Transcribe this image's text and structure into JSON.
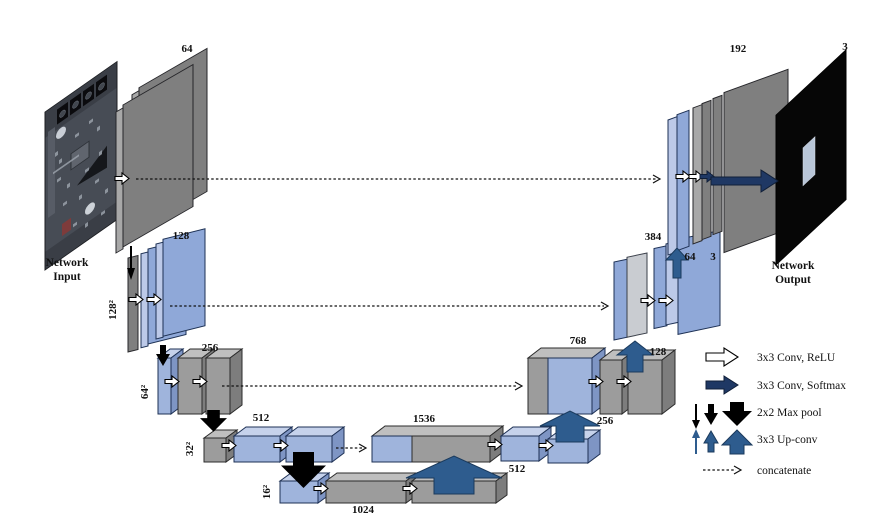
{
  "network": {
    "input": {
      "caption_line1": "Network",
      "caption_line2": "Input"
    },
    "output": {
      "caption_line1": "Network",
      "caption_line2": "Output",
      "channels": "3"
    },
    "encoder": {
      "row1_channels": "64",
      "row2_channels": "128",
      "row2_resolution": "128²",
      "row3_channels": "256",
      "row3_resolution": "64²",
      "row4_channels": "512",
      "row4_resolution": "32²",
      "bottleneck_channels": "1024",
      "bottleneck_resolution": "16²"
    },
    "decoder": {
      "row4_concat_channels": "1536",
      "row4_conv_channels": "512",
      "row3_concat_channels": "768",
      "row3_upconv_channels": "256",
      "row2_concat_channels": "384",
      "row2_upconv_channels": "128",
      "row2_conv_channels": "64",
      "row2_out_channels": "3",
      "row1_concat_channels": "192"
    },
    "legend": {
      "conv_relu": "3x3 Conv, ReLU",
      "conv_softmax": "3x3 Conv, Softmax",
      "max_pool": "2x2 Max pool",
      "up_conv": "3x3 Up-conv",
      "concatenate": "concatenate"
    },
    "colors": {
      "feature_map_gray": "#9c9c9c",
      "feature_map_blue": "#9fb4dc",
      "concat_gray": "#c9ccd1",
      "conv_softmax_arrow": "#1f3864",
      "up_conv_arrow": "#2e5c8e",
      "max_pool_arrow": "#000000"
    }
  }
}
